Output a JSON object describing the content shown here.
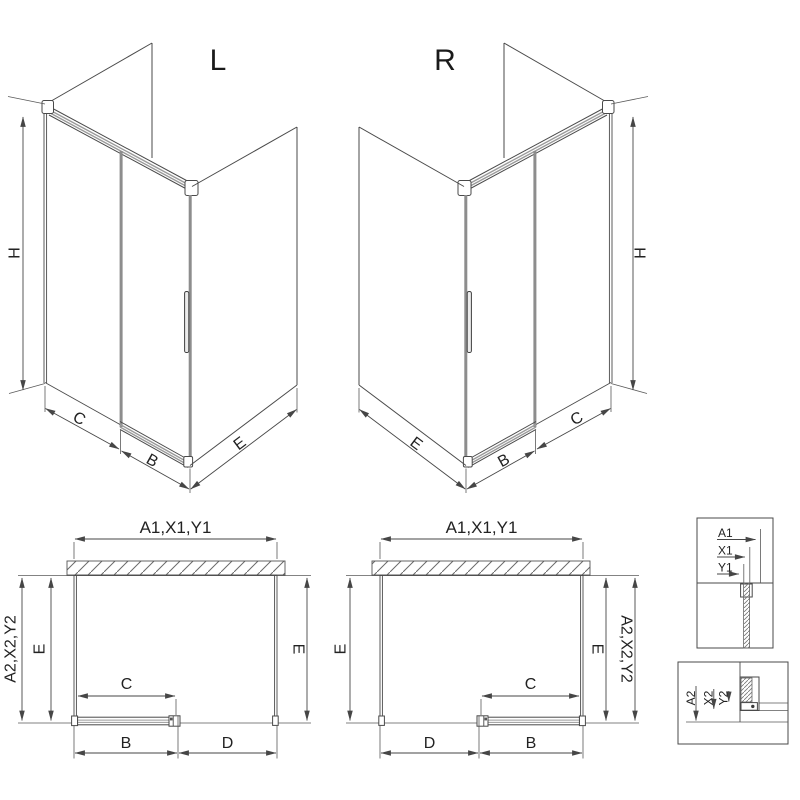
{
  "colors": {
    "line": "#4a4a4a",
    "rail": "#8d8d8d",
    "text": "#222222",
    "background": "#ffffff"
  },
  "iso_left": {
    "variant_label": "L",
    "dim_height": "H",
    "dim_front": "C",
    "dim_door": "B",
    "dim_side": "E"
  },
  "iso_right": {
    "variant_label": "R",
    "dim_height": "H",
    "dim_front": "C",
    "dim_door": "B",
    "dim_side": "E"
  },
  "plan_left": {
    "dim_width": "A1,X1,Y1",
    "dim_depth_outer": "A2,X2,Y2",
    "dim_depth_left": "E",
    "dim_depth_right": "E",
    "dim_panel": "C",
    "dim_door": "B",
    "dim_fixed": "D"
  },
  "plan_right": {
    "dim_width": "A1,X1,Y1",
    "dim_depth_outer": "A2,X2,Y2",
    "dim_depth_left": "E",
    "dim_depth_right": "E",
    "dim_panel": "C",
    "dim_door": "B",
    "dim_fixed": "D"
  },
  "detail_wall_profile": {
    "row1": "A1",
    "row2": "X1",
    "row3": "Y1"
  },
  "detail_floor_profile": {
    "row1": "A2",
    "row2": "X2",
    "row3": "Y2"
  }
}
